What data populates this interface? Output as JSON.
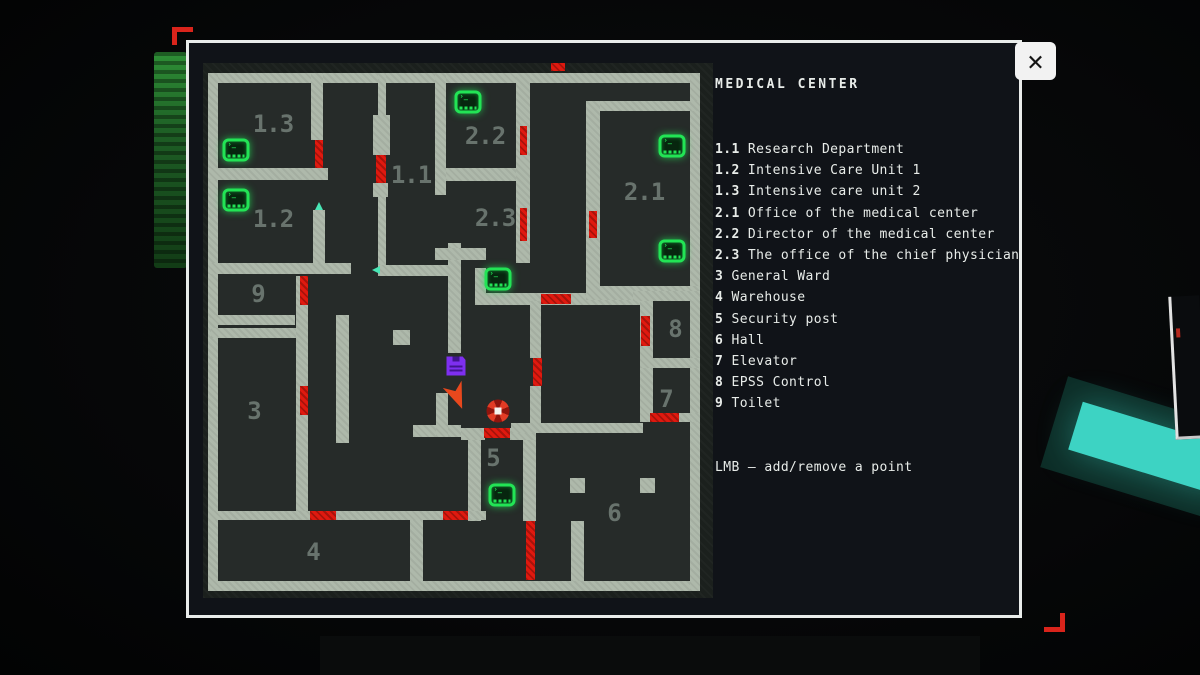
{
  "window": {
    "close_glyph": "✕"
  },
  "legend": {
    "title": "MEDICAL CENTER",
    "items": [
      {
        "num": "1.1",
        "name": "Research Department"
      },
      {
        "num": "1.2",
        "name": "Intensive Care Unit 1"
      },
      {
        "num": "1.3",
        "name": "Intensive care unit 2"
      },
      {
        "num": "2.1",
        "name": "Office of the medical center"
      },
      {
        "num": "2.2",
        "name": "Director of the medical center"
      },
      {
        "num": "2.3",
        "name": "The office of the chief physician"
      },
      {
        "num": "3",
        "name": "General Ward"
      },
      {
        "num": "4",
        "name": "Warehouse"
      },
      {
        "num": "5",
        "name": "Security post"
      },
      {
        "num": "6",
        "name": "Hall"
      },
      {
        "num": "7",
        "name": "Elevator"
      },
      {
        "num": "8",
        "name": "EPSS Control"
      },
      {
        "num": "9",
        "name": "Toilet"
      }
    ],
    "footer": "LMB – add/remove a point"
  },
  "colors": {
    "wall": "#aeb9ab",
    "floor": "#262b29",
    "door_red": "#e0190f",
    "terminal_green": "#22e455",
    "save_purple": "#7e2ff0",
    "player_orange": "#e8481d",
    "label_gray": "#68736d",
    "panel_bg": "#101318",
    "accent_red": "#d9241b",
    "lamp_cyan": "#3dd3c3"
  },
  "map": {
    "interior": {
      "x": 5,
      "y": 10,
      "w": 492,
      "h": 518
    },
    "walls": [
      {
        "x": 5,
        "y": 10,
        "w": 492,
        "h": 10
      },
      {
        "x": 5,
        "y": 10,
        "w": 10,
        "h": 518
      },
      {
        "x": 5,
        "y": 518,
        "w": 492,
        "h": 10
      },
      {
        "x": 487,
        "y": 10,
        "w": 10,
        "h": 518
      },
      {
        "x": 395,
        "y": 38,
        "w": 102,
        "h": 10
      },
      {
        "x": 5,
        "y": 105,
        "w": 120,
        "h": 12
      },
      {
        "x": 108,
        "y": 10,
        "w": 12,
        "h": 67
      },
      {
        "x": 110,
        "y": 147,
        "w": 12,
        "h": 55
      },
      {
        "x": 5,
        "y": 200,
        "w": 143,
        "h": 11
      },
      {
        "x": 8,
        "y": 252,
        "w": 84,
        "h": 10
      },
      {
        "x": 8,
        "y": 265,
        "w": 87,
        "h": 10
      },
      {
        "x": 93,
        "y": 213,
        "w": 12,
        "h": 235
      },
      {
        "x": 133,
        "y": 252,
        "w": 13,
        "h": 128
      },
      {
        "x": 190,
        "y": 267,
        "w": 17,
        "h": 15
      },
      {
        "x": 175,
        "y": 10,
        "w": 8,
        "h": 44
      },
      {
        "x": 170,
        "y": 52,
        "w": 17,
        "h": 40
      },
      {
        "x": 170,
        "y": 120,
        "w": 15,
        "h": 14
      },
      {
        "x": 175,
        "y": 134,
        "w": 8,
        "h": 68
      },
      {
        "x": 232,
        "y": 10,
        "w": 11,
        "h": 122
      },
      {
        "x": 245,
        "y": 180,
        "w": 13,
        "h": 110
      },
      {
        "x": 175,
        "y": 202,
        "w": 70,
        "h": 11
      },
      {
        "x": 272,
        "y": 205,
        "w": 11,
        "h": 37
      },
      {
        "x": 272,
        "y": 230,
        "w": 168,
        "h": 12
      },
      {
        "x": 313,
        "y": 10,
        "w": 14,
        "h": 190
      },
      {
        "x": 243,
        "y": 105,
        "w": 70,
        "h": 13
      },
      {
        "x": 232,
        "y": 185,
        "w": 51,
        "h": 12
      },
      {
        "x": 383,
        "y": 38,
        "w": 14,
        "h": 185
      },
      {
        "x": 383,
        "y": 223,
        "w": 114,
        "h": 14
      },
      {
        "x": 430,
        "y": 228,
        "w": 67,
        "h": 10
      },
      {
        "x": 437,
        "y": 238,
        "w": 13,
        "h": 60
      },
      {
        "x": 437,
        "y": 295,
        "w": 60,
        "h": 10
      },
      {
        "x": 437,
        "y": 305,
        "w": 13,
        "h": 47
      },
      {
        "x": 437,
        "y": 350,
        "w": 60,
        "h": 9
      },
      {
        "x": 327,
        "y": 238,
        "w": 11,
        "h": 57
      },
      {
        "x": 327,
        "y": 323,
        "w": 11,
        "h": 45
      },
      {
        "x": 210,
        "y": 362,
        "w": 48,
        "h": 12
      },
      {
        "x": 233,
        "y": 330,
        "w": 12,
        "h": 44
      },
      {
        "x": 258,
        "y": 365,
        "w": 24,
        "h": 12
      },
      {
        "x": 307,
        "y": 365,
        "w": 26,
        "h": 12
      },
      {
        "x": 308,
        "y": 360,
        "w": 132,
        "h": 10
      },
      {
        "x": 265,
        "y": 377,
        "w": 13,
        "h": 81
      },
      {
        "x": 320,
        "y": 377,
        "w": 13,
        "h": 81
      },
      {
        "x": 5,
        "y": 448,
        "w": 278,
        "h": 9
      },
      {
        "x": 207,
        "y": 457,
        "w": 13,
        "h": 61
      },
      {
        "x": 368,
        "y": 458,
        "w": 13,
        "h": 60
      },
      {
        "x": 367,
        "y": 415,
        "w": 15,
        "h": 15
      },
      {
        "x": 437,
        "y": 415,
        "w": 15,
        "h": 15
      }
    ],
    "doors": [
      {
        "x": 112,
        "y": 77,
        "w": 8,
        "h": 28
      },
      {
        "x": 173,
        "y": 92,
        "w": 10,
        "h": 28
      },
      {
        "x": 317,
        "y": 63,
        "w": 7,
        "h": 29
      },
      {
        "x": 317,
        "y": 145,
        "w": 7,
        "h": 33
      },
      {
        "x": 386,
        "y": 148,
        "w": 8,
        "h": 27
      },
      {
        "x": 97,
        "y": 213,
        "w": 8,
        "h": 29
      },
      {
        "x": 97,
        "y": 323,
        "w": 8,
        "h": 29
      },
      {
        "x": 338,
        "y": 231,
        "w": 30,
        "h": 10
      },
      {
        "x": 438,
        "y": 253,
        "w": 9,
        "h": 30
      },
      {
        "x": 330,
        "y": 295,
        "w": 9,
        "h": 28
      },
      {
        "x": 447,
        "y": 350,
        "w": 29,
        "h": 9
      },
      {
        "x": 281,
        "y": 365,
        "w": 26,
        "h": 10
      },
      {
        "x": 107,
        "y": 448,
        "w": 26,
        "h": 9
      },
      {
        "x": 240,
        "y": 448,
        "w": 25,
        "h": 9
      },
      {
        "x": 323,
        "y": 458,
        "w": 9,
        "h": 59
      },
      {
        "x": 348,
        "y": 0,
        "w": 14,
        "h": 8
      }
    ],
    "rooms": [
      {
        "label": "1.3",
        "x": 70,
        "y": 61
      },
      {
        "label": "1.2",
        "x": 70,
        "y": 156
      },
      {
        "label": "1.1",
        "x": 208,
        "y": 112
      },
      {
        "label": "2.2",
        "x": 282,
        "y": 73
      },
      {
        "label": "2.3",
        "x": 292,
        "y": 155
      },
      {
        "label": "2.1",
        "x": 441,
        "y": 129
      },
      {
        "label": "9",
        "x": 55,
        "y": 231
      },
      {
        "label": "3",
        "x": 51,
        "y": 348
      },
      {
        "label": "8",
        "x": 472,
        "y": 266
      },
      {
        "label": "7",
        "x": 463,
        "y": 336
      },
      {
        "label": "5",
        "x": 290,
        "y": 395
      },
      {
        "label": "6",
        "x": 411,
        "y": 450
      },
      {
        "label": "4",
        "x": 110,
        "y": 489
      }
    ],
    "terminals": [
      {
        "x": 33,
        "y": 87
      },
      {
        "x": 33,
        "y": 137
      },
      {
        "x": 265,
        "y": 39
      },
      {
        "x": 469,
        "y": 83
      },
      {
        "x": 469,
        "y": 188
      },
      {
        "x": 295,
        "y": 216
      },
      {
        "x": 299,
        "y": 432
      }
    ],
    "markers": {
      "save": {
        "x": 253,
        "y": 303
      },
      "player": {
        "x": 255,
        "y": 333
      },
      "waypoint": {
        "x": 295,
        "y": 348
      },
      "nav_dots": [
        {
          "x": 116,
          "y": 143,
          "dir": "up"
        },
        {
          "x": 173,
          "y": 207,
          "dir": "left"
        }
      ]
    }
  }
}
